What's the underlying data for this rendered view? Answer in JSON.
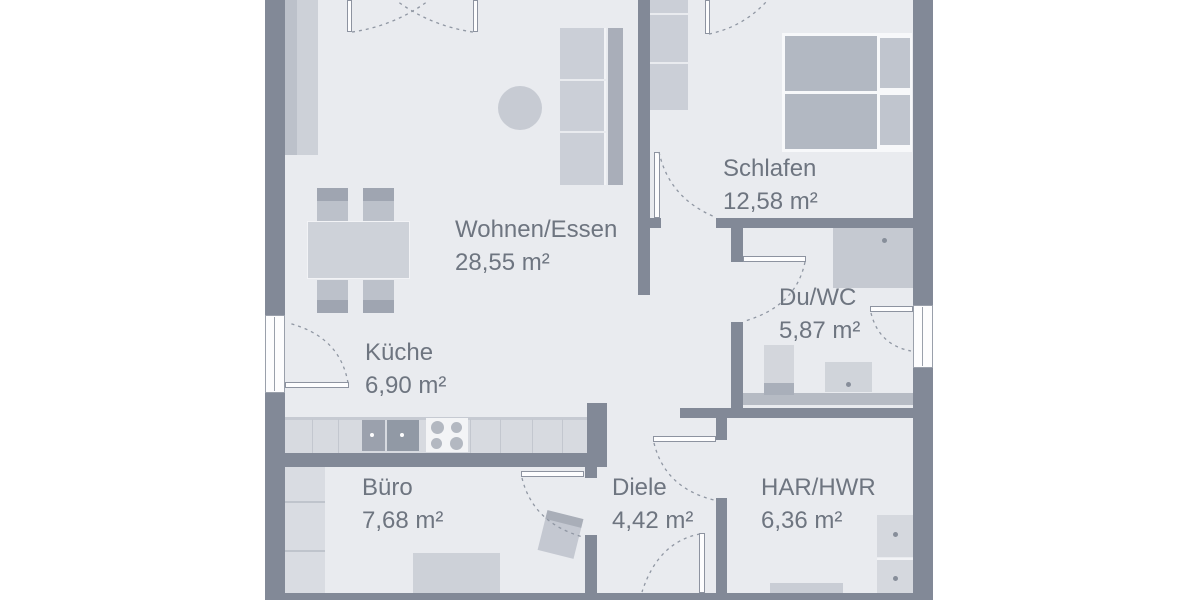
{
  "plan": {
    "type": "floor-plan",
    "language": "de",
    "rooms": [
      {
        "id": "wohnen-essen",
        "name": "Wohnen/Essen",
        "area": "28,55 m²"
      },
      {
        "id": "schlafen",
        "name": "Schlafen",
        "area": "12,58 m²"
      },
      {
        "id": "du-wc",
        "name": "Du/WC",
        "area": "5,87 m²"
      },
      {
        "id": "kueche",
        "name": "Küche",
        "area": "6,90 m²"
      },
      {
        "id": "buero",
        "name": "Büro",
        "area": "7,68 m²"
      },
      {
        "id": "diele",
        "name": "Diele",
        "area": "4,42 m²"
      },
      {
        "id": "har-hwr",
        "name": "HAR/HWR",
        "area": "6,36 m²"
      }
    ],
    "colors": {
      "wall": "#828997",
      "floor": "#e9ebef",
      "furniture_light": "#ced2d9",
      "furniture_medium": "#b9bec7",
      "furniture_dark": "#a9aeb9",
      "label_text": "#6e7580",
      "background": "#ffffff"
    }
  }
}
